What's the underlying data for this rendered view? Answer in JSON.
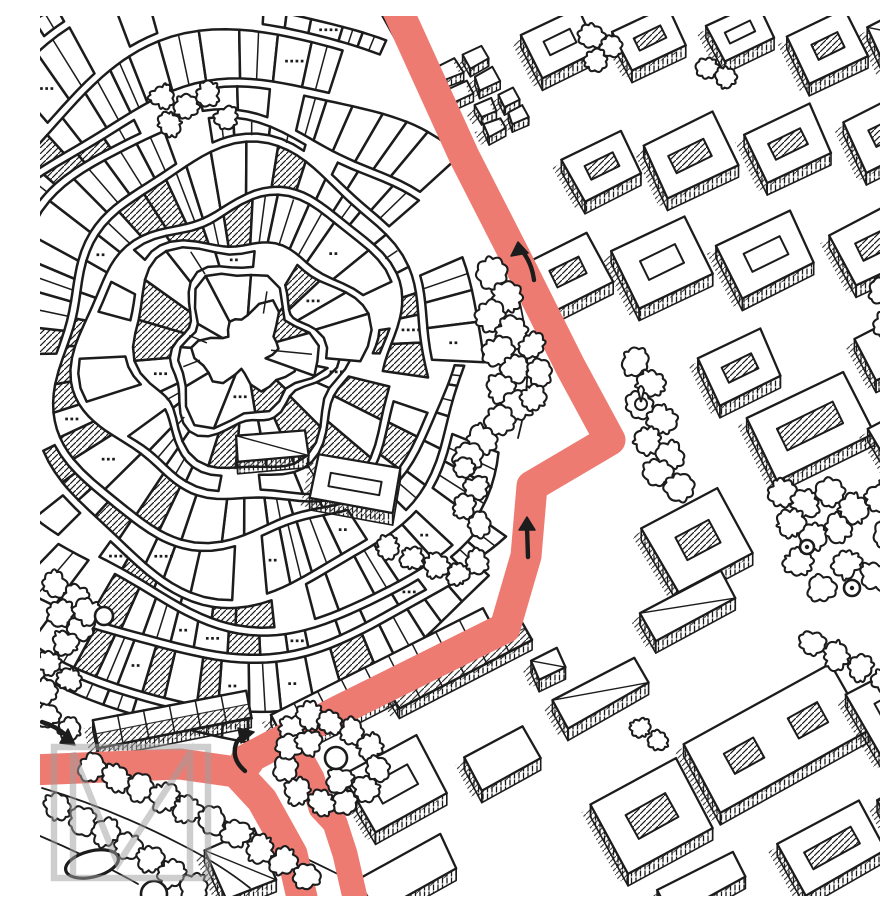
{
  "meta": {
    "title": "Hand-drawn isometric city map with highlighted walking route",
    "watermark_letter": "M"
  },
  "palette": {
    "paper": "#ffffff",
    "ink": "#1c1c1c",
    "route": "#ee7b72",
    "watermark": "#9f9f9f"
  },
  "route": {
    "color": "#ee7b72",
    "segments": [
      {
        "name": "avenue-and-old-town-street",
        "width": 31,
        "pts": [
          [
            354,
            -14
          ],
          [
            424,
            140
          ],
          [
            474,
            238
          ],
          [
            530,
            350
          ],
          [
            570,
            424
          ],
          [
            492,
            470
          ],
          [
            486,
            540
          ],
          [
            465,
            612
          ],
          [
            300,
            694
          ],
          [
            205,
            744
          ]
        ]
      },
      {
        "name": "west-arm-to-bottom",
        "width": 31,
        "pts": [
          [
            -10,
            754
          ],
          [
            140,
            748
          ],
          [
            196,
            756
          ],
          [
            222,
            784
          ],
          [
            252,
            838
          ],
          [
            263,
            886
          ]
        ]
      },
      {
        "name": "parallel-branch-strip",
        "width": 25,
        "pts": [
          [
            250,
            722
          ],
          [
            272,
            762
          ],
          [
            281,
            792
          ],
          [
            295,
            807
          ],
          [
            305,
            838
          ],
          [
            316,
            886
          ]
        ]
      }
    ]
  },
  "arrows": [
    {
      "name": "arrow-avenue-up",
      "shaft": "M494,264 Q492,248 483,236",
      "head": [
        [
          478,
          226
        ],
        [
          471,
          240
        ],
        [
          488,
          237
        ]
      ]
    },
    {
      "name": "arrow-mid-up",
      "shaft": "M488,541 L487,511",
      "head": [
        [
          487,
          501
        ],
        [
          479,
          514
        ],
        [
          495,
          514
        ]
      ]
    },
    {
      "name": "arrow-turn-right",
      "shaft": "M205,755 Q191,743 196,728 Q198,723 203,720",
      "head": [
        [
          214,
          716
        ],
        [
          198,
          712
        ],
        [
          201,
          727
        ]
      ]
    },
    {
      "name": "arrow-west-east",
      "shaft": "M2,706 Q16,710 27,720",
      "head": [
        [
          35,
          729
        ],
        [
          20,
          727
        ],
        [
          28,
          713
        ]
      ]
    }
  ],
  "watermark": {
    "frame": {
      "x": 14,
      "y": 731,
      "w": 154,
      "h": 131
    },
    "m_path": "M33,862 L33,737 L78,848 L150,737 L150,862",
    "stroke_width": 6.5,
    "opacity": 0.5
  },
  "old_town": {
    "center": [
      205,
      335
    ],
    "first_ring": 34,
    "ring_gap": 40,
    "rings": 11,
    "boundary": [
      [
        0,
        0
      ],
      [
        345,
        0
      ],
      [
        352,
        22
      ],
      [
        302,
        58
      ],
      [
        332,
        96
      ],
      [
        430,
        170
      ],
      [
        455,
        245
      ],
      [
        438,
        310
      ],
      [
        425,
        385
      ],
      [
        440,
        442
      ],
      [
        452,
        556
      ],
      [
        440,
        606
      ],
      [
        378,
        648
      ],
      [
        300,
        686
      ],
      [
        228,
        720
      ],
      [
        150,
        714
      ],
      [
        60,
        700
      ],
      [
        0,
        694
      ]
    ],
    "route_clearance": 29
  },
  "edges": [
    "M340,-4 L420,140 L466,236",
    "M470,252 Q500,340 478,422",
    "M2,772 Q70,792 140,828 Q180,848 210,872",
    "M0,820 Q52,842 98,868",
    "M36,742 Q160,790 306,862"
  ],
  "terraces": [
    {
      "cx": 345,
      "cy": 662,
      "w": 238,
      "h": 36,
      "rot": -27
    },
    {
      "cx": 132,
      "cy": 703,
      "w": 158,
      "h": 30,
      "rot": -11
    },
    {
      "cx": 418,
      "cy": 646,
      "w": 150,
      "h": 30,
      "rot": -27
    }
  ],
  "blocks": [
    {
      "cx": 520,
      "cy": 26,
      "w": 62,
      "h": 48,
      "rot": -26,
      "type": "court"
    },
    {
      "cx": 610,
      "cy": 22,
      "w": 60,
      "h": 44,
      "rot": -26,
      "type": "court"
    },
    {
      "cx": 700,
      "cy": 16,
      "w": 56,
      "h": 40,
      "rot": -26,
      "type": "court"
    },
    {
      "cx": 788,
      "cy": 30,
      "w": 64,
      "h": 52,
      "rot": -26,
      "type": "court"
    },
    {
      "cx": 862,
      "cy": 18,
      "w": 56,
      "h": 44,
      "rot": -26,
      "type": "slab"
    },
    {
      "cx": 428,
      "cy": 58,
      "w": 50,
      "h": 40,
      "rot": -26,
      "type": "boxes"
    },
    {
      "cx": 462,
      "cy": 96,
      "w": 44,
      "h": 34,
      "rot": -26,
      "type": "boxes"
    },
    {
      "cx": 562,
      "cy": 150,
      "w": 64,
      "h": 48,
      "rot": -26,
      "type": "court"
    },
    {
      "cx": 650,
      "cy": 140,
      "w": 78,
      "h": 58,
      "rot": -26,
      "type": "court"
    },
    {
      "cx": 748,
      "cy": 128,
      "w": 72,
      "h": 54,
      "rot": -26,
      "type": "court"
    },
    {
      "cx": 846,
      "cy": 116,
      "w": 68,
      "h": 56,
      "rot": -26,
      "type": "court"
    },
    {
      "cx": 528,
      "cy": 256,
      "w": 70,
      "h": 56,
      "rot": -26,
      "type": "court"
    },
    {
      "cx": 622,
      "cy": 246,
      "w": 80,
      "h": 62,
      "rot": -26,
      "type": "court"
    },
    {
      "cx": 726,
      "cy": 238,
      "w": 80,
      "h": 60,
      "rot": -26,
      "type": "court"
    },
    {
      "cx": 836,
      "cy": 228,
      "w": 76,
      "h": 58,
      "rot": -26,
      "type": "court"
    },
    {
      "cx": 700,
      "cy": 352,
      "w": 68,
      "h": 52,
      "rot": -26,
      "type": "court"
    },
    {
      "cx": 770,
      "cy": 410,
      "w": 108,
      "h": 70,
      "rot": -26,
      "type": "court",
      "hatchCourt": true
    },
    {
      "cx": 852,
      "cy": 330,
      "w": 60,
      "h": 48,
      "rot": -26,
      "type": "slab"
    },
    {
      "cx": 866,
      "cy": 424,
      "w": 54,
      "h": 56,
      "rot": -28,
      "type": "slab"
    },
    {
      "cx": 658,
      "cy": 524,
      "w": 86,
      "h": 74,
      "rot": -28,
      "type": "court",
      "hatchCourt": true
    },
    {
      "cx": 648,
      "cy": 590,
      "w": 92,
      "h": 34,
      "rot": -28,
      "type": "slab"
    },
    {
      "cx": 872,
      "cy": 472,
      "w": 50,
      "h": 40,
      "rot": -28,
      "type": "slab"
    },
    {
      "cx": 355,
      "cy": 768,
      "w": 84,
      "h": 66,
      "rot": -29,
      "type": "court"
    },
    {
      "cx": 368,
      "cy": 858,
      "w": 92,
      "h": 38,
      "rot": -29,
      "type": "slab"
    },
    {
      "cx": 462,
      "cy": 742,
      "w": 66,
      "h": 38,
      "rot": -29,
      "type": "slab"
    },
    {
      "cx": 560,
      "cy": 676,
      "w": 92,
      "h": 30,
      "rot": -29,
      "type": "slab"
    },
    {
      "cx": 612,
      "cy": 800,
      "w": 96,
      "h": 78,
      "rot": -29,
      "type": "court"
    },
    {
      "cx": 736,
      "cy": 722,
      "w": 168,
      "h": 78,
      "rot": -29,
      "type": "court2"
    },
    {
      "cx": 852,
      "cy": 698,
      "w": 62,
      "h": 76,
      "rot": -29,
      "type": "court"
    },
    {
      "cx": 792,
      "cy": 832,
      "w": 92,
      "h": 58,
      "rot": -29,
      "type": "court"
    },
    {
      "cx": 662,
      "cy": 868,
      "w": 84,
      "h": 30,
      "rot": -29,
      "type": "slab"
    },
    {
      "cx": 872,
      "cy": 788,
      "w": 60,
      "h": 40,
      "rot": -29,
      "type": "slab"
    },
    {
      "cx": 508,
      "cy": 648,
      "w": 30,
      "h": 22,
      "rot": -29,
      "type": "slab"
    },
    {
      "cx": 200,
      "cy": 848,
      "w": 54,
      "h": 56,
      "rot": -24,
      "type": "slab"
    },
    {
      "cx": 315,
      "cy": 468,
      "w": 82,
      "h": 44,
      "rot": 10,
      "type": "court"
    },
    {
      "cx": 232,
      "cy": 430,
      "w": 72,
      "h": 26,
      "rot": -6,
      "type": "slab"
    }
  ],
  "trees": {
    "clusters": [
      {
        "r": 14,
        "pts": [
          [
            452,
            258
          ],
          [
            466,
            282
          ],
          [
            451,
            300
          ],
          [
            472,
            316
          ],
          [
            458,
            336
          ],
          [
            476,
            352
          ],
          [
            462,
            372
          ],
          [
            478,
            390
          ],
          [
            460,
            405
          ],
          [
            441,
            424
          ],
          [
            428,
            440
          ]
        ]
      },
      {
        "r": 12,
        "pts": [
          [
            492,
            330
          ],
          [
            500,
            356
          ],
          [
            492,
            382
          ]
        ]
      },
      {
        "r": 11,
        "pts": [
          [
            552,
            20
          ],
          [
            571,
            30
          ],
          [
            556,
            44
          ]
        ]
      },
      {
        "r": 10,
        "pts": [
          [
            668,
            52
          ],
          [
            686,
            62
          ]
        ]
      },
      {
        "r": 13,
        "pts": [
          [
            596,
            345
          ],
          [
            612,
            368
          ],
          [
            600,
            390
          ],
          [
            622,
            404
          ],
          [
            608,
            424
          ],
          [
            630,
            440
          ],
          [
            618,
            458
          ],
          [
            640,
            470
          ]
        ]
      },
      {
        "r": 12,
        "pts": [
          [
            252,
            712
          ],
          [
            270,
            700
          ],
          [
            290,
            706
          ],
          [
            312,
            716
          ],
          [
            330,
            730
          ],
          [
            338,
            752
          ],
          [
            326,
            772
          ],
          [
            306,
            786
          ],
          [
            282,
            788
          ],
          [
            258,
            776
          ],
          [
            246,
            752
          ],
          [
            250,
            730
          ],
          [
            268,
            726
          ],
          [
            300,
            764
          ]
        ]
      },
      {
        "r": 13,
        "pts": [
          [
            52,
            752
          ],
          [
            76,
            762
          ],
          [
            100,
            772
          ],
          [
            124,
            782
          ],
          [
            148,
            794
          ],
          [
            172,
            806
          ],
          [
            196,
            818
          ],
          [
            220,
            832
          ],
          [
            244,
            846
          ],
          [
            266,
            860
          ]
        ]
      },
      {
        "r": 13,
        "pts": [
          [
            18,
            792
          ],
          [
            42,
            804
          ],
          [
            66,
            816
          ],
          [
            88,
            830
          ],
          [
            110,
            844
          ],
          [
            132,
            858
          ],
          [
            154,
            872
          ]
        ]
      },
      {
        "r": 11,
        "pts": [
          [
            8,
            700
          ],
          [
            30,
            712
          ],
          [
            10,
            648
          ],
          [
            30,
            664
          ],
          [
            6,
            676
          ]
        ]
      },
      {
        "r": 13,
        "pts": [
          [
            742,
            476
          ],
          [
            766,
            488
          ],
          [
            790,
            478
          ],
          [
            814,
            492
          ],
          [
            838,
            482
          ],
          [
            862,
            496
          ],
          [
            750,
            508
          ],
          [
            774,
            520
          ],
          [
            798,
            512
          ],
          [
            846,
            518
          ],
          [
            870,
            532
          ],
          [
            758,
            546
          ],
          [
            806,
            548
          ],
          [
            834,
            560
          ],
          [
            862,
            572
          ],
          [
            782,
            572
          ]
        ]
      },
      {
        "r": 12,
        "pts": [
          [
            842,
            276
          ],
          [
            862,
            290
          ],
          [
            846,
            308
          ],
          [
            866,
            322
          ]
        ]
      },
      {
        "r": 11,
        "pts": [
          [
            122,
            80
          ],
          [
            146,
            92
          ],
          [
            168,
            78
          ],
          [
            186,
            102
          ],
          [
            130,
            108
          ]
        ]
      },
      {
        "r": 11,
        "pts": [
          [
            348,
            532
          ],
          [
            372,
            542
          ],
          [
            396,
            550
          ],
          [
            418,
            558
          ],
          [
            436,
            546
          ]
        ]
      },
      {
        "r": 11,
        "pts": [
          [
            424,
            452
          ],
          [
            436,
            472
          ],
          [
            424,
            492
          ],
          [
            438,
            508
          ]
        ]
      },
      {
        "r": 12,
        "pts": [
          [
            14,
            568
          ],
          [
            36,
            582
          ],
          [
            20,
            598
          ],
          [
            42,
            612
          ],
          [
            26,
            628
          ],
          [
            48,
            596
          ]
        ]
      },
      {
        "r": 12,
        "pts": [
          [
            772,
            628
          ],
          [
            796,
            640
          ],
          [
            820,
            652
          ],
          [
            844,
            664
          ],
          [
            868,
            676
          ]
        ]
      },
      {
        "r": 9,
        "pts": [
          [
            600,
            712
          ],
          [
            618,
            724
          ]
        ]
      }
    ]
  },
  "ponds": [
    {
      "type": "ellipse",
      "cx": 52,
      "cy": 848,
      "rx": 27,
      "ry": 13,
      "rot": -14
    },
    {
      "type": "circle",
      "cx": 114,
      "cy": 878,
      "r": 13
    },
    {
      "type": "circle",
      "cx": 296,
      "cy": 742,
      "r": 11
    },
    {
      "type": "circle",
      "cx": 767,
      "cy": 531,
      "r": 7,
      "dot": true
    },
    {
      "type": "circle",
      "cx": 812,
      "cy": 572,
      "r": 8,
      "dot": true
    },
    {
      "type": "circle",
      "cx": 64,
      "cy": 600,
      "r": 9
    }
  ],
  "monument": {
    "x": 601,
    "y": 380
  }
}
